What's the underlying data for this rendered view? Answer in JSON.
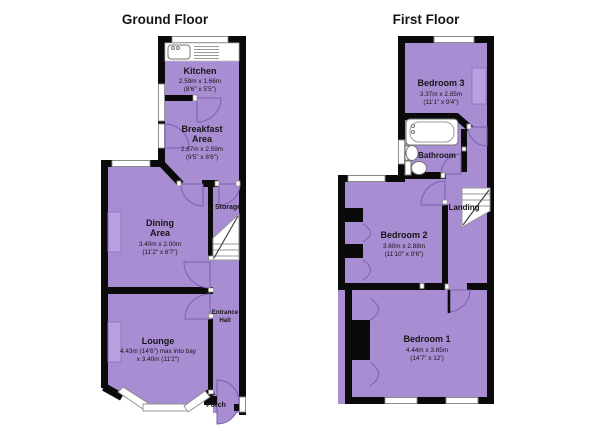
{
  "colors": {
    "room_fill": "#a88dd3",
    "wall": "#0a0a0a",
    "door_arc": "#7b61ad",
    "window_fill": "#ffffff",
    "background": "#ffffff"
  },
  "ground": {
    "title": "Ground Floor",
    "kitchen": {
      "name": "Kitchen",
      "metric": "2.59m x 1.66m",
      "imperial": "(8'6\" x 5'5\")"
    },
    "breakfast": {
      "name_line1": "Breakfast",
      "name_line2": "Area",
      "metric": "2.87m x 2.59m",
      "imperial": "(9'5\" x 8'6\")"
    },
    "dining": {
      "name_line1": "Dining",
      "name_line2": "Area",
      "metric": "3.40m x 2.00m",
      "imperial": "(11'2\" x 6'7\")"
    },
    "storage": {
      "name": "Storage"
    },
    "entrance": {
      "name_line1": "Entrance",
      "name_line2": "Hall"
    },
    "lounge": {
      "name": "Lounge",
      "metric": "4.43m (14'6\") max into bay",
      "imperial": "x 3.40m (11'2\")"
    },
    "porch": {
      "name": "Porch"
    }
  },
  "first": {
    "title": "First Floor",
    "bedroom3": {
      "name": "Bedroom 3",
      "metric": "3.37m x 2.85m",
      "imperial": "(11'1\" x 9'4\")"
    },
    "bathroom": {
      "name": "Bathroom"
    },
    "landing": {
      "name": "Landing"
    },
    "bedroom2": {
      "name": "Bedroom 2",
      "metric": "3.60m x 2.88m",
      "imperial": "(11'10\" x 9'6\")"
    },
    "bedroom1": {
      "name": "Bedroom 1",
      "metric": "4.44m x 3.65m",
      "imperial": "(14'7\" x 12')"
    }
  }
}
